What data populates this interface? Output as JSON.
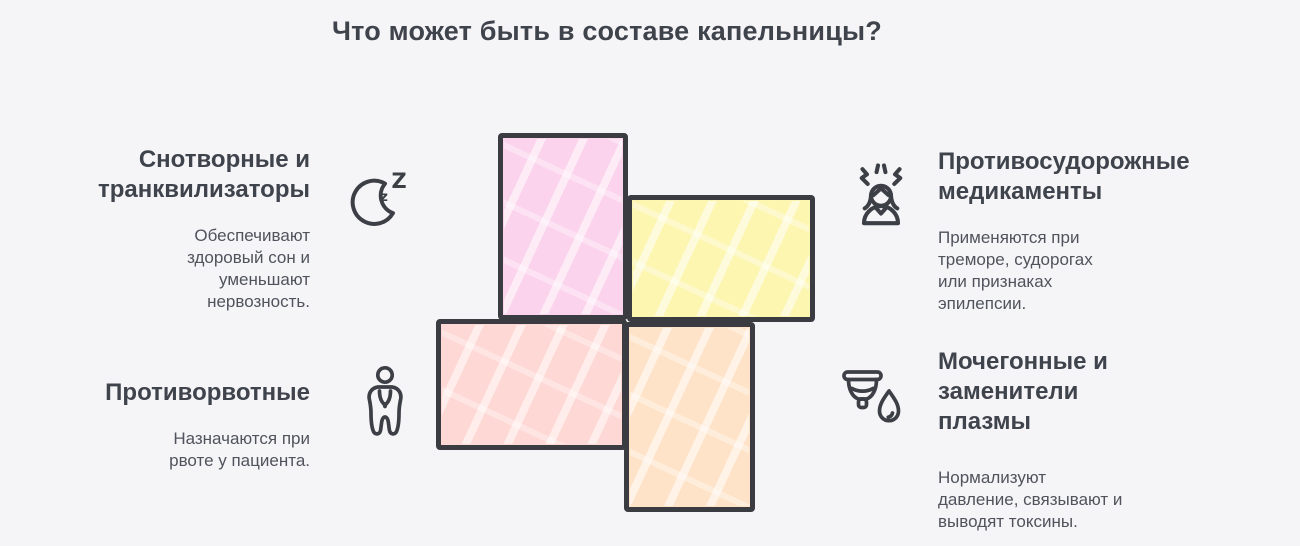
{
  "title": "Что может быть в составе капельницы?",
  "items": [
    {
      "heading": "Снотворные и транквилизаторы",
      "description": "Обеспечивают здоровый сон и уменьшают нервозность.",
      "icon": "sleep-moon-zzz"
    },
    {
      "heading": "Противосудорожные медикаменты",
      "description": "Применяются при треморе, судорогах или признаках эпилепсии.",
      "icon": "tremor-person"
    },
    {
      "heading": "Противорвотные",
      "description": "Назначаются при рвоте у пациента.",
      "icon": "nausea-person"
    },
    {
      "heading": "Мочегонные и заменители плазмы",
      "description": "Нормализуют давление, связывают и выводят токсины.",
      "icon": "cup-with-drop"
    }
  ],
  "cross": {
    "blocks": [
      {
        "position": "top",
        "color": "#fbd3ec"
      },
      {
        "position": "right",
        "color": "#fcf6b1"
      },
      {
        "position": "left",
        "color": "#fed8d4"
      },
      {
        "position": "bottom",
        "color": "#fee3c8"
      }
    ]
  },
  "colors": {
    "background": "#f5f5f8",
    "title_text": "#3f434c",
    "heading_text": "#3f434c",
    "body_text": "#50535c",
    "icon_stroke": "#3c3f45",
    "cross_outline": "#3a3c42"
  }
}
